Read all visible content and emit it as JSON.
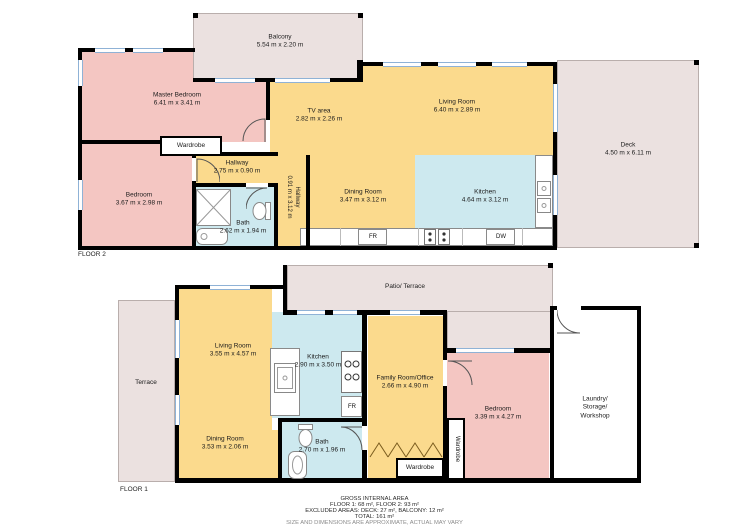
{
  "colors": {
    "bedroom_fill": "#f4c6c2",
    "living_fill": "#fbda8d",
    "wet_fill": "#cde9ef",
    "outdoor_fill": "#ebe1e0",
    "wall": "#000000",
    "window_line": "#8fb2d6"
  },
  "floor2": {
    "label": "FLOOR 2",
    "balcony": {
      "name": "Balcony",
      "dims": "5.54 m x 2.20 m"
    },
    "master_bedroom": {
      "name": "Master Bedroom",
      "dims": "6.41 m x 3.41 m"
    },
    "tv_area": {
      "name": "TV area",
      "dims": "2.82 m x 2.26 m"
    },
    "living_room": {
      "name": "Living Room",
      "dims": "6.40 m x 2.89 m"
    },
    "deck": {
      "name": "Deck",
      "dims": "4.50 m x 6.11 m"
    },
    "bedroom": {
      "name": "Bedroom",
      "dims": "3.67 m x 2.98 m"
    },
    "wardrobe": {
      "name": "Wardrobe"
    },
    "hallway": {
      "name": "Hallway",
      "dims": "2.75 m x 0.90 m"
    },
    "hallway_vertical": {
      "name": "Hallway",
      "dims": "0.91 m x 3.12 m"
    },
    "bath": {
      "name": "Bath",
      "dims": "2.62 m x 1.94 m"
    },
    "dining_room": {
      "name": "Dining Room",
      "dims": "3.47 m x 3.12 m"
    },
    "kitchen": {
      "name": "Kitchen",
      "dims": "4.64 m x 3.12 m"
    },
    "fridge": "FR",
    "dishwasher": "DW"
  },
  "floor1": {
    "label": "FLOOR 1",
    "terrace": {
      "name": "Terrace"
    },
    "patio": {
      "name": "Patio/ Terrace"
    },
    "living_room": {
      "name": "Living Room",
      "dims": "3.55 m x 4.57 m"
    },
    "kitchen": {
      "name": "Kitchen",
      "dims": "2.90 m x 3.50 m"
    },
    "family_room": {
      "name": "Family Room/Office",
      "dims": "2.66 m x 4.90 m"
    },
    "dining_room": {
      "name": "Dining Room",
      "dims": "3.53 m x 2.06 m"
    },
    "bath": {
      "name": "Bath",
      "dims": "2.70 m x 1.96 m"
    },
    "bedroom": {
      "name": "Bedroom",
      "dims": "3.39 m x 4.27 m"
    },
    "laundry": {
      "line1": "Laundry/",
      "line2": "Storage/",
      "line3": "Workshop"
    },
    "wardrobe_bedroom": {
      "name": "Wardrobe"
    },
    "wardrobe_hall": {
      "name": "Wardrobe"
    },
    "fridge": "FR"
  },
  "footer": {
    "title": "GROSS INTERNAL AREA",
    "floors": "FLOOR 1: 68 m², FLOOR 2: 93 m²",
    "excluded": "EXCLUDED AREAS: DECK: 27 m², BALCONY: 12 m²",
    "total": "TOTAL: 161 m²",
    "disclaimer": "SIZE AND DIMENSIONS ARE APPROXIMATE, ACTUAL MAY VARY"
  }
}
